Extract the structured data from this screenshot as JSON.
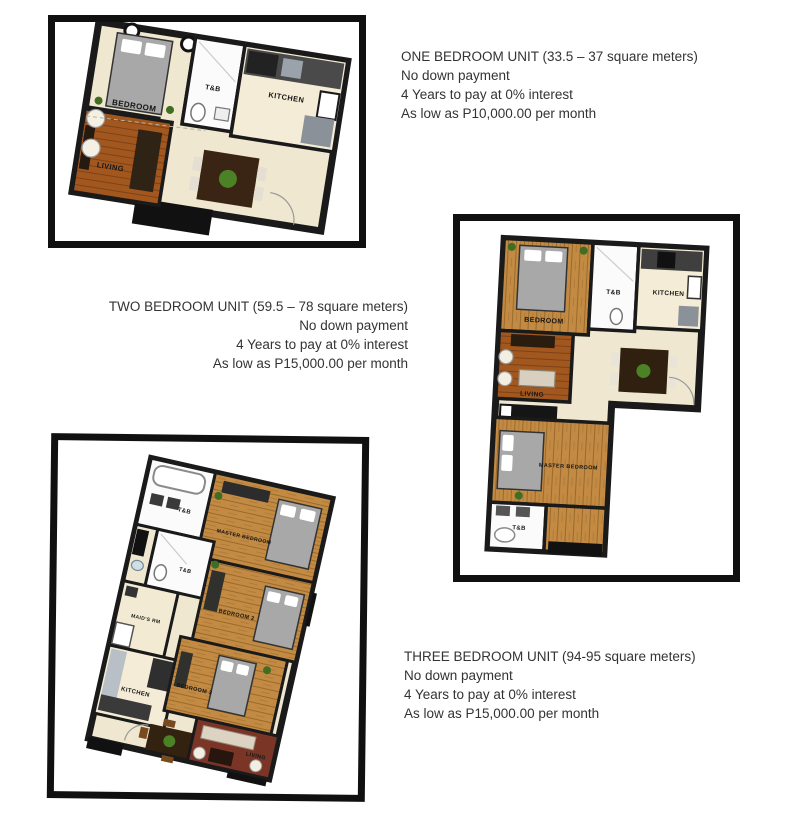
{
  "page": {
    "background": "#ffffff"
  },
  "palette": {
    "frame_border": "#101010",
    "wall": "#1a1a1a",
    "floor_cream": "#efe7d0",
    "floor_wood": "#c28a43",
    "floor_orange": "#a2571f",
    "floor_red": "#7a3527",
    "bathroom_white": "#fbfbfb",
    "bed_gray": "#a8a8a8",
    "plant_green": "#4c8226",
    "text": "#333333"
  },
  "units": [
    {
      "name": "one-bedroom",
      "title": "ONE BEDROOM UNIT (33.5 – 37 square meters)",
      "lines": [
        "No down payment",
        "4 Years to pay at 0% interest",
        "As low as P10,000.00 per month"
      ],
      "rooms": {
        "bedroom": "BEDROOM",
        "tb": "T&B",
        "kitchen": "KITCHEN",
        "living": "LIVING"
      }
    },
    {
      "name": "two-bedroom",
      "title": "TWO BEDROOM UNIT (59.5 – 78 square meters)",
      "lines": [
        "No down payment",
        "4 Years to pay at 0% interest",
        "As low as P15,000.00 per month"
      ],
      "rooms": {
        "bedroom": "BEDROOM",
        "tb": "T&B",
        "kitchen": "KITCHEN",
        "living": "LIVING",
        "master": "MASTER BEDROOM",
        "tb2": "T&B"
      }
    },
    {
      "name": "three-bedroom",
      "title": "THREE BEDROOM UNIT (94-95 square meters)",
      "lines": [
        "No down payment",
        "4 Years to pay at 0% interest",
        "As low as P15,000.00 per month"
      ],
      "rooms": {
        "tb1": "T&B",
        "master": "MASTER BEDROOM",
        "tb2": "T&B",
        "maids": "MAID'S RM",
        "bedroom2": "BEDROOM 2",
        "bedroom3": "BEDROOM 3",
        "kitchen": "KITCHEN",
        "living": "LIVING"
      }
    }
  ]
}
